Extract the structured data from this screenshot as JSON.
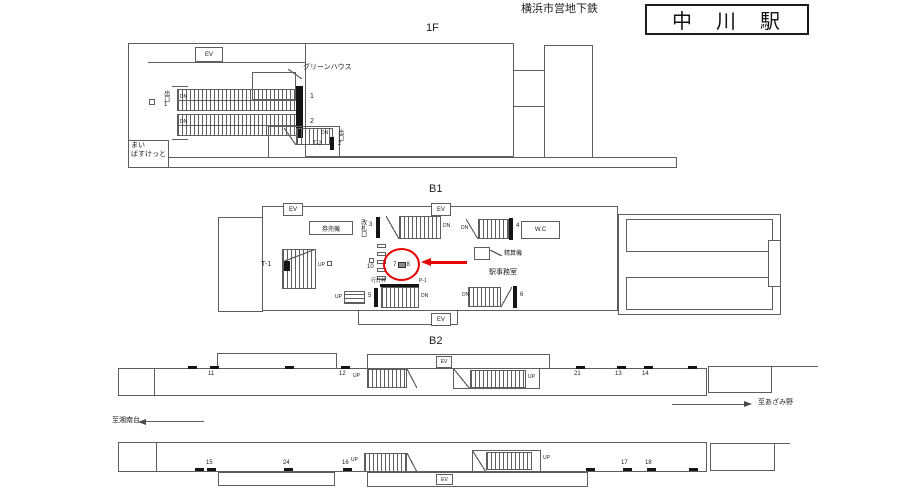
{
  "header": {
    "operator": "横浜市営地下鉄",
    "station": "中　川　駅"
  },
  "common": {
    "ev": "EV",
    "up": "UP",
    "dn": "DN"
  },
  "annotation": {
    "highlight_left": "7",
    "highlight_right": "8",
    "color": "#e60000"
  },
  "f1": {
    "label": "1F",
    "greenhouse": "グリーンハウス",
    "exit1": "出口1",
    "exit2": "出口2",
    "store1": "まい",
    "store2": "ばすけっと",
    "n1": "1",
    "n2": "2",
    "t2": "T-2"
  },
  "b1": {
    "label": "B1",
    "ticket_machines": "券売機",
    "ticket_gate": "改札口",
    "n3": "3",
    "n4": "4",
    "n5": "5",
    "n6": "6",
    "n10": "10",
    "t1": "T-1",
    "wc": "W.C",
    "fare_machine": "精算機",
    "office": "駅事務室",
    "andon_frame": "行灯枠",
    "p1": "P-1"
  },
  "b2_upper": {
    "label": "B2",
    "n11": "11",
    "n12": "12",
    "n21": "21",
    "n13": "13",
    "n14": "14",
    "to_right": "至あざみ野"
  },
  "b2_lower": {
    "to_left": "至湘南台",
    "n15": "15",
    "n24": "24",
    "n16": "16",
    "n17": "17",
    "n18": "18"
  }
}
